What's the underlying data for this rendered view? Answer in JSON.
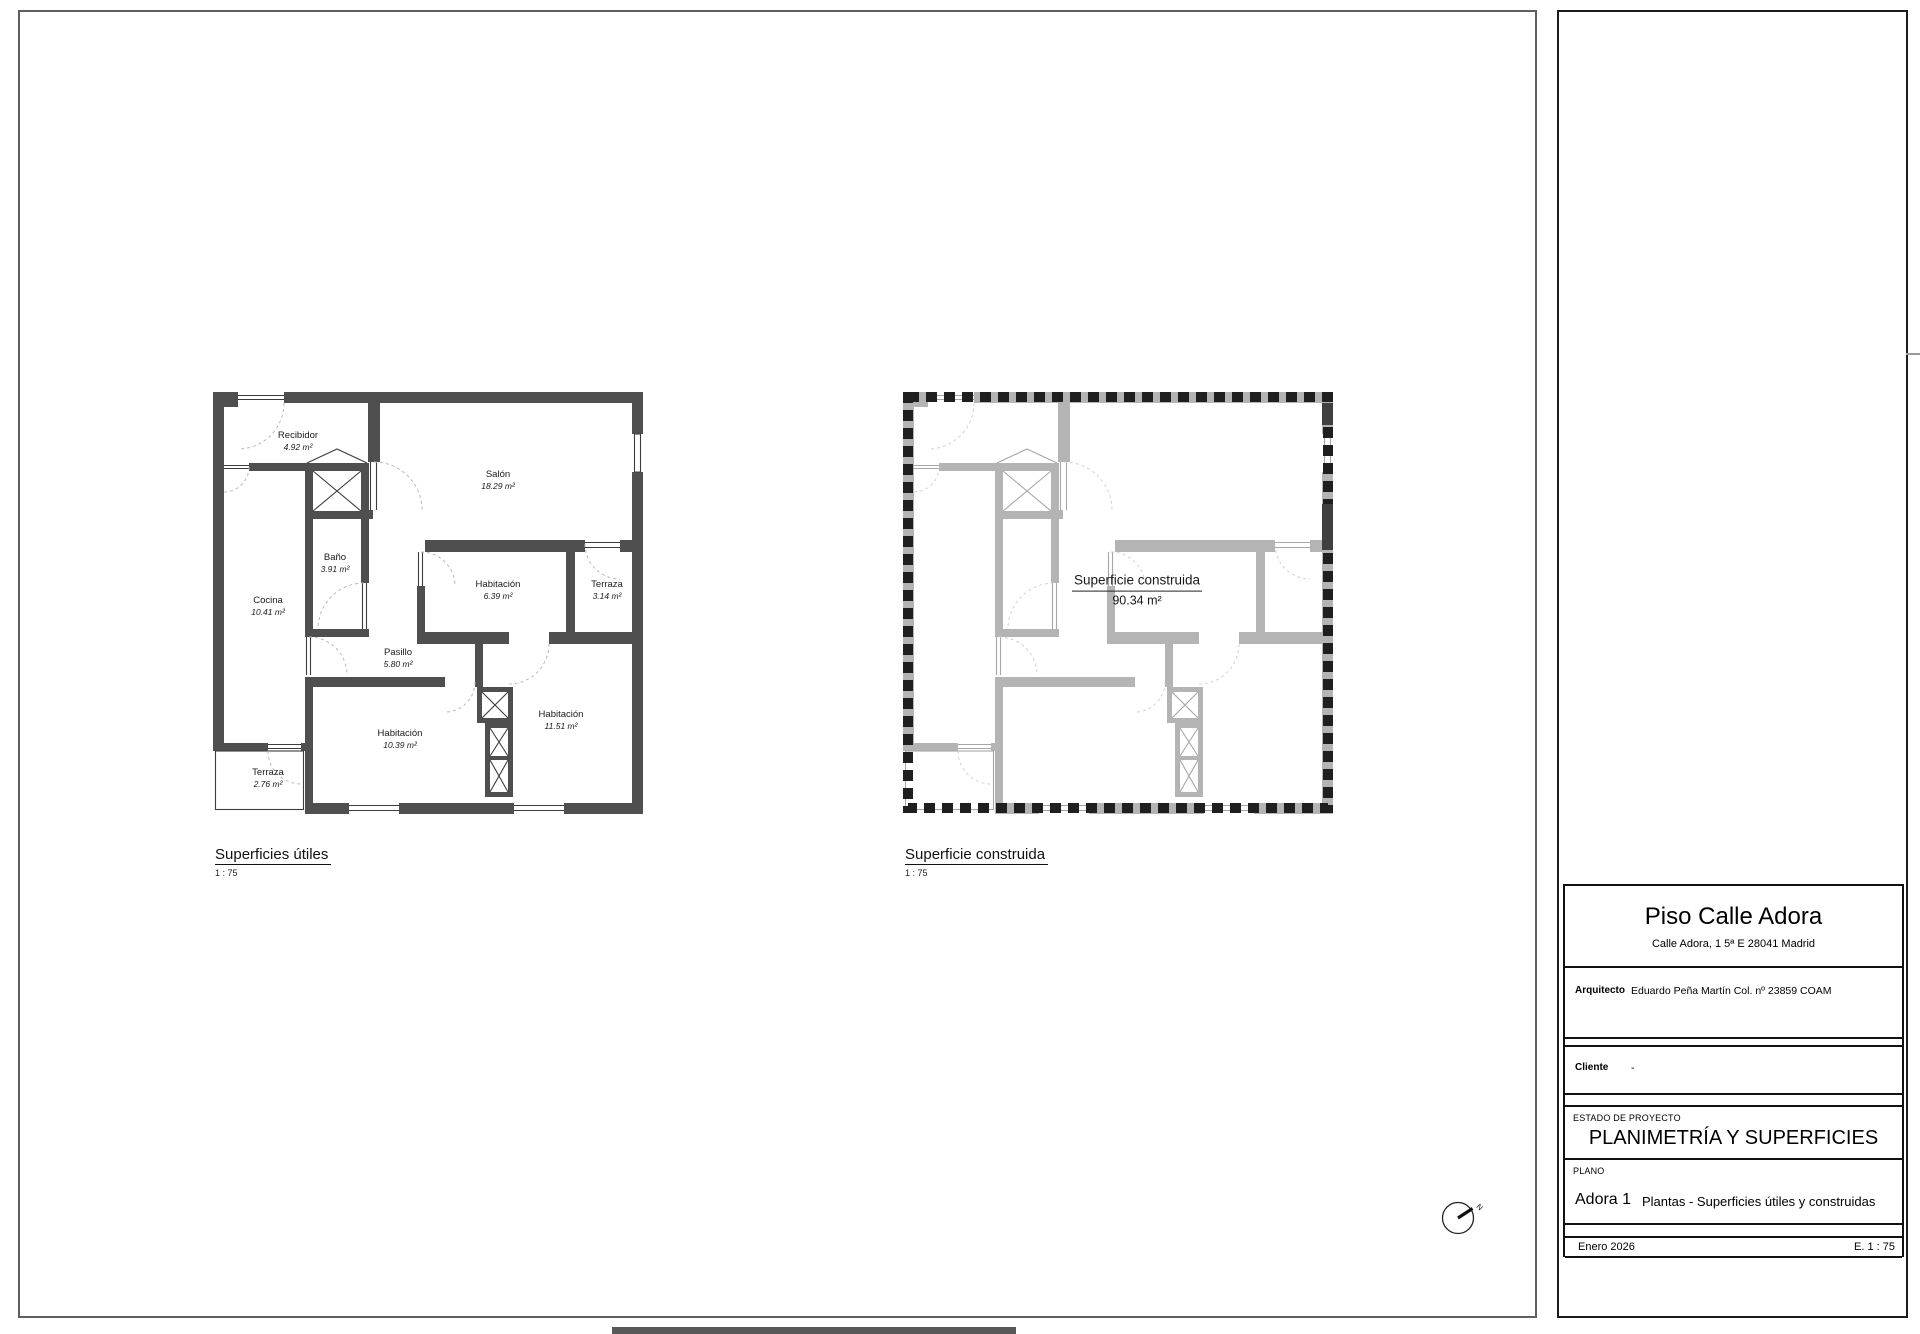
{
  "sheet": {
    "plans": {
      "left": {
        "caption": "Superficies útiles",
        "scale": "1 : 75",
        "rooms": [
          {
            "name": "Recibidor",
            "area": "4.92 m²"
          },
          {
            "name": "Salón",
            "area": "18.29 m²"
          },
          {
            "name": "Baño",
            "area": "3.91 m²"
          },
          {
            "name": "Cocina",
            "area": "10.41 m²"
          },
          {
            "name": "Habitación",
            "area": "6.39 m²"
          },
          {
            "name": "Terraza",
            "area": "3.14 m²"
          },
          {
            "name": "Pasillo",
            "area": "5.80 m²"
          },
          {
            "name": "Habitación",
            "area": "10.39 m²"
          },
          {
            "name": "Habitación",
            "area": "11.51 m²"
          },
          {
            "name": "Terraza",
            "area": "2.76 m²"
          }
        ]
      },
      "right": {
        "caption": "Superficie construida",
        "scale": "1 : 75",
        "label": {
          "name": "Superficie construida",
          "area": "90.34 m²"
        }
      }
    },
    "north_indicator": "N",
    "title_block": {
      "project_title": "Piso Calle Adora",
      "project_address": "Calle Adora, 1 5ª E 28041 Madrid",
      "architect_label": "Arquitecto",
      "architect_value": "Eduardo Peña Martín  Col. nº 23859 COAM",
      "client_label": "Cliente",
      "client_value": "-",
      "estado_label": "ESTADO DE PROYECTO",
      "estado_value": "PLANIMETRÍA Y SUPERFICIES",
      "plano_label": "PLANO",
      "plano_code": "Adora 1",
      "plano_value": "Plantas - Superficies útiles y construidas",
      "date": "Enero 2026",
      "scale": "E. 1 : 75"
    },
    "colors": {
      "wall_dark": "#4f4f4f",
      "wall_light": "#b4b4b4",
      "perimeter_dash": "#1f1f1f"
    }
  }
}
